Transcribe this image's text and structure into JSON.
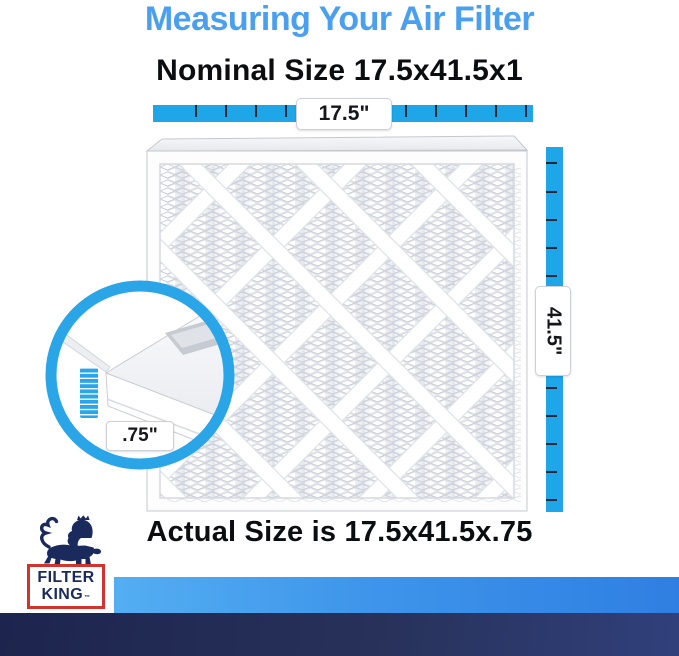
{
  "title": "Measuring Your Air Filter",
  "headings": {
    "nominal": "Nominal Size 17.5x41.5x1",
    "actual": "Actual Size is 17.5x41.5x.75"
  },
  "dimensions": {
    "width": "17.5\"",
    "height": "41.5\"",
    "depth": ".75\""
  },
  "nominal_size_in": {
    "width": 17.5,
    "height": 41.5,
    "depth": 1
  },
  "actual_size_in": {
    "width": 17.5,
    "height": 41.5,
    "depth": 0.75
  },
  "brand": {
    "name_line1": "FILTER",
    "name_line2": "KING",
    "trademark": "™",
    "logo_icon": "crowned-lion"
  },
  "colors": {
    "title_blue": "#4aa0ee",
    "ruler_blue": "#1ea6e8",
    "callout_blue": "#29a5e8",
    "brand_navy": "#1b2a5c",
    "brand_red": "#d0342c",
    "footer_light_blue": "#3e95ea",
    "footer_navy": "#273159"
  }
}
